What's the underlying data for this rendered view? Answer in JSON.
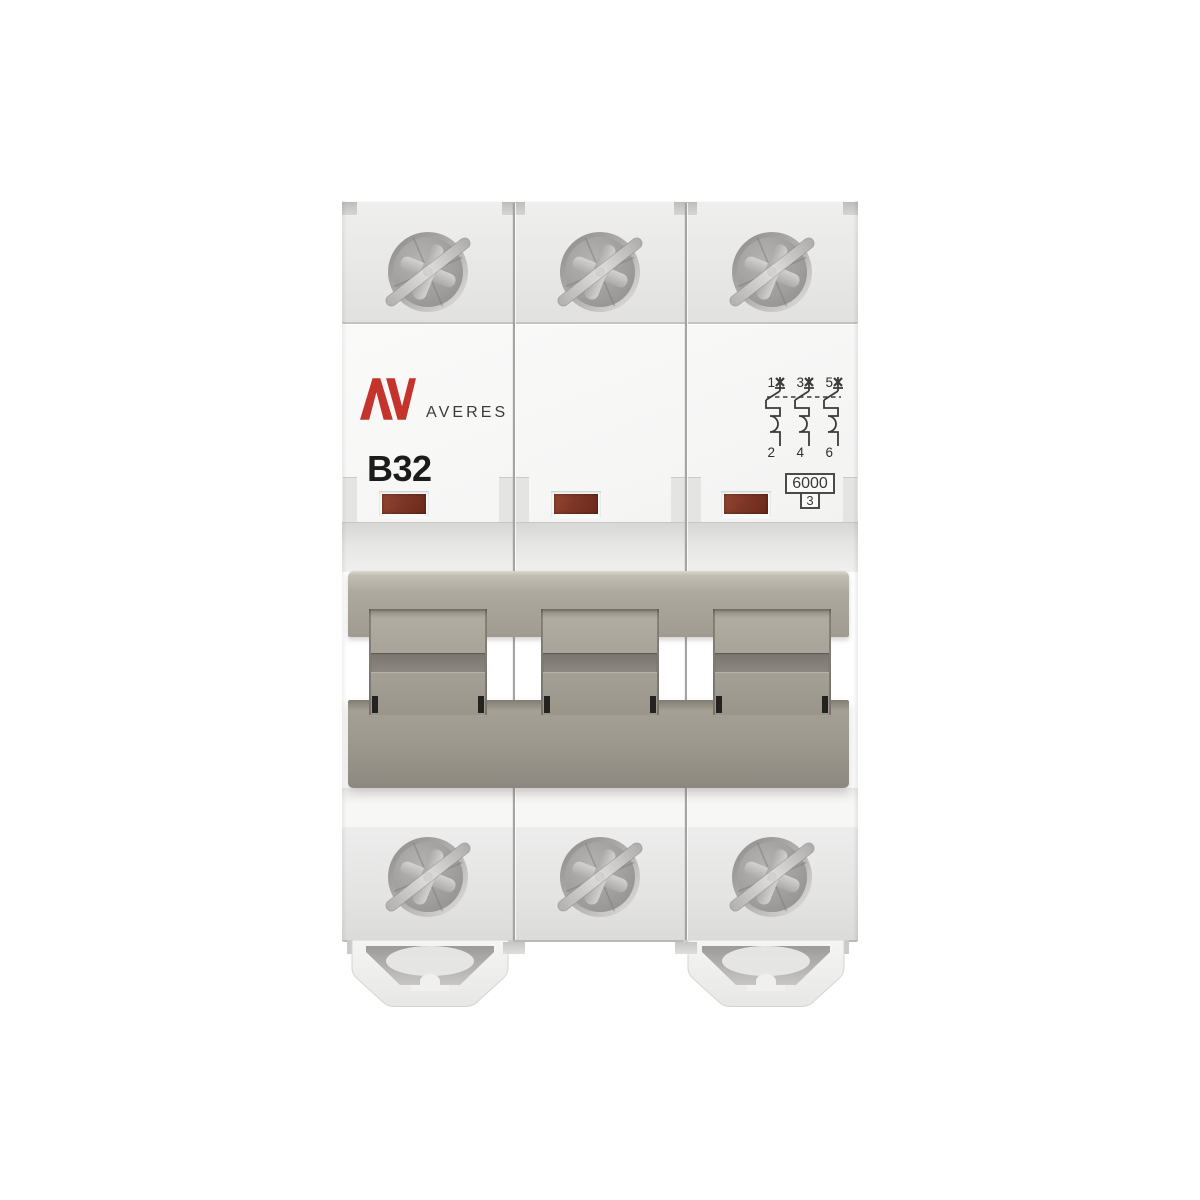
{
  "product": {
    "brand_mark": "AV",
    "brand_name": "AVERES",
    "rating_marking": "B32",
    "breaking_capacity_marking": "6000",
    "energy_limiting_class_marking": "3",
    "pole_count": 3
  },
  "wiring_diagram": {
    "top_terminal_labels": [
      "1",
      "3",
      "5"
    ],
    "bottom_terminal_labels": [
      "2",
      "4",
      "6"
    ]
  },
  "indicator_windows": {
    "count": 3,
    "color": "#7c3423"
  },
  "colors": {
    "brand_red": "#c5332d",
    "body_white": "#f7f7f6",
    "terminal_block_gray": "#e9e9e8",
    "handle_taupe": "#a39e94",
    "screw_metal": "#a3a2a0",
    "background": "#ffffff"
  },
  "icons": {
    "screw": "pozidriv-screw-icon",
    "clip": "din-rail-clip",
    "diagram": "three-pole-circuit-diagram-icon"
  }
}
